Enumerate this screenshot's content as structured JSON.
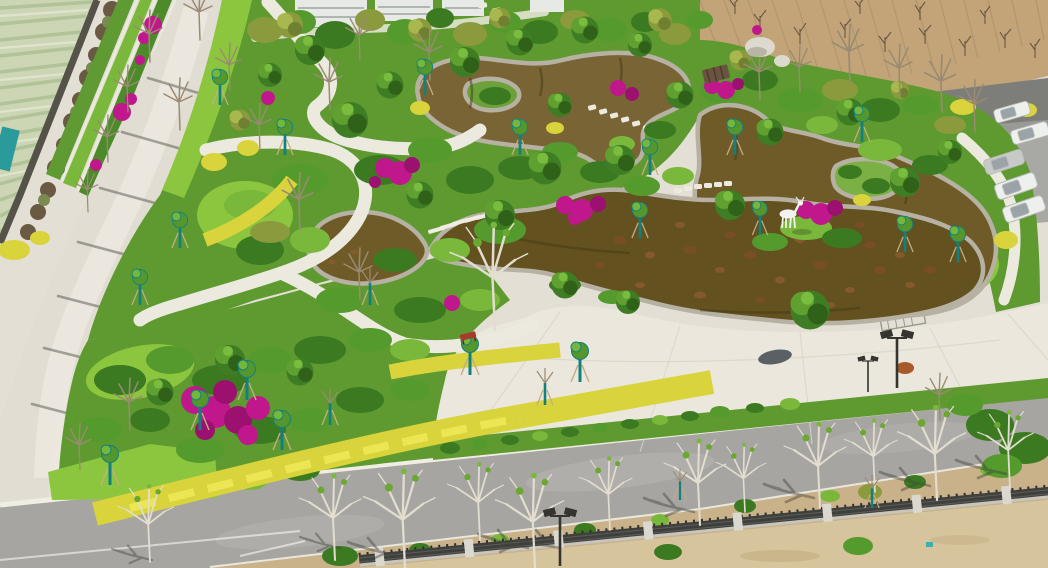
{
  "scene": {
    "type": "aerial-photograph",
    "subject": "Daytime drone view of a newly landscaped park: a free-form brown koi pond with light stone curbs and planted islands, winding white paths, a concrete plaza with a white deer sculpture, magenta bougainvillea, yellow hedges, young staked trees, bordered by farmland and a boundary wall (upper left), a bare dirt field with parked cars (upper right), and an asphalt road with an iron fence and sandy ground (bottom)"
  },
  "inventory": [
    "pond-basins",
    "stone-curbs",
    "island-planters",
    "stepping-stones",
    "garden-steps",
    "deer-sculpture",
    "wood-bridge",
    "shade-canopy",
    "plaza",
    "winding-paths",
    "west-concrete-road",
    "asphalt-road",
    "solar-street-lamps",
    "red-bench",
    "yellow-hedges",
    "bougainvillea-clusters",
    "shrub-masses",
    "lawns",
    "young-staked-trees",
    "bare-white-trees",
    "farmland-rows",
    "greenhouse-patch",
    "boundary-wall",
    "terrace-beds",
    "dirt-field",
    "parking-lot",
    "parked-cars",
    "iron-fence",
    "stone-fence-posts",
    "sand-ground",
    "white-boulders",
    "background-buildings",
    "tree-shadows",
    "drain-grate"
  ],
  "colors": {
    "pond_water": "#63521f",
    "pond_water_light": "#786434",
    "pond_water_mid": "#6e5b28",
    "stone_curb": "#b6b1a3",
    "plaza_concrete": "#ebe7dc",
    "park_road_concrete": "#e1ddd3",
    "asphalt_road": "#a6a5a1",
    "garden_green": "#5f9a31",
    "lawn_green": "#8cc63f",
    "hedge_yellow": "#d9d33c",
    "bougainvillea_magenta": "#c0188c",
    "tree_support_teal": "#12807f",
    "dirt_field_tan": "#c2a478",
    "planting_strip_dirt": "#c9b189",
    "sand_tan": "#d6c49c",
    "fence_metal_dark": "#3f3f3d",
    "fence_post_light": "#dbd8cf",
    "wall_dark": "#55524a",
    "farmland_pale": "#ccd6b4",
    "greenhouse_teal": "#2a9a9a",
    "deer_white": "#f2f2ee",
    "bench_red": "#a83c2c",
    "lamp_dark": "#35342f",
    "vehicle_white": "#eef0ee",
    "boulder_gray": "#dcd9ce",
    "building_white": "#e7e9e6",
    "path_white": "#ece9df",
    "curb_white": "#f0ede3"
  }
}
